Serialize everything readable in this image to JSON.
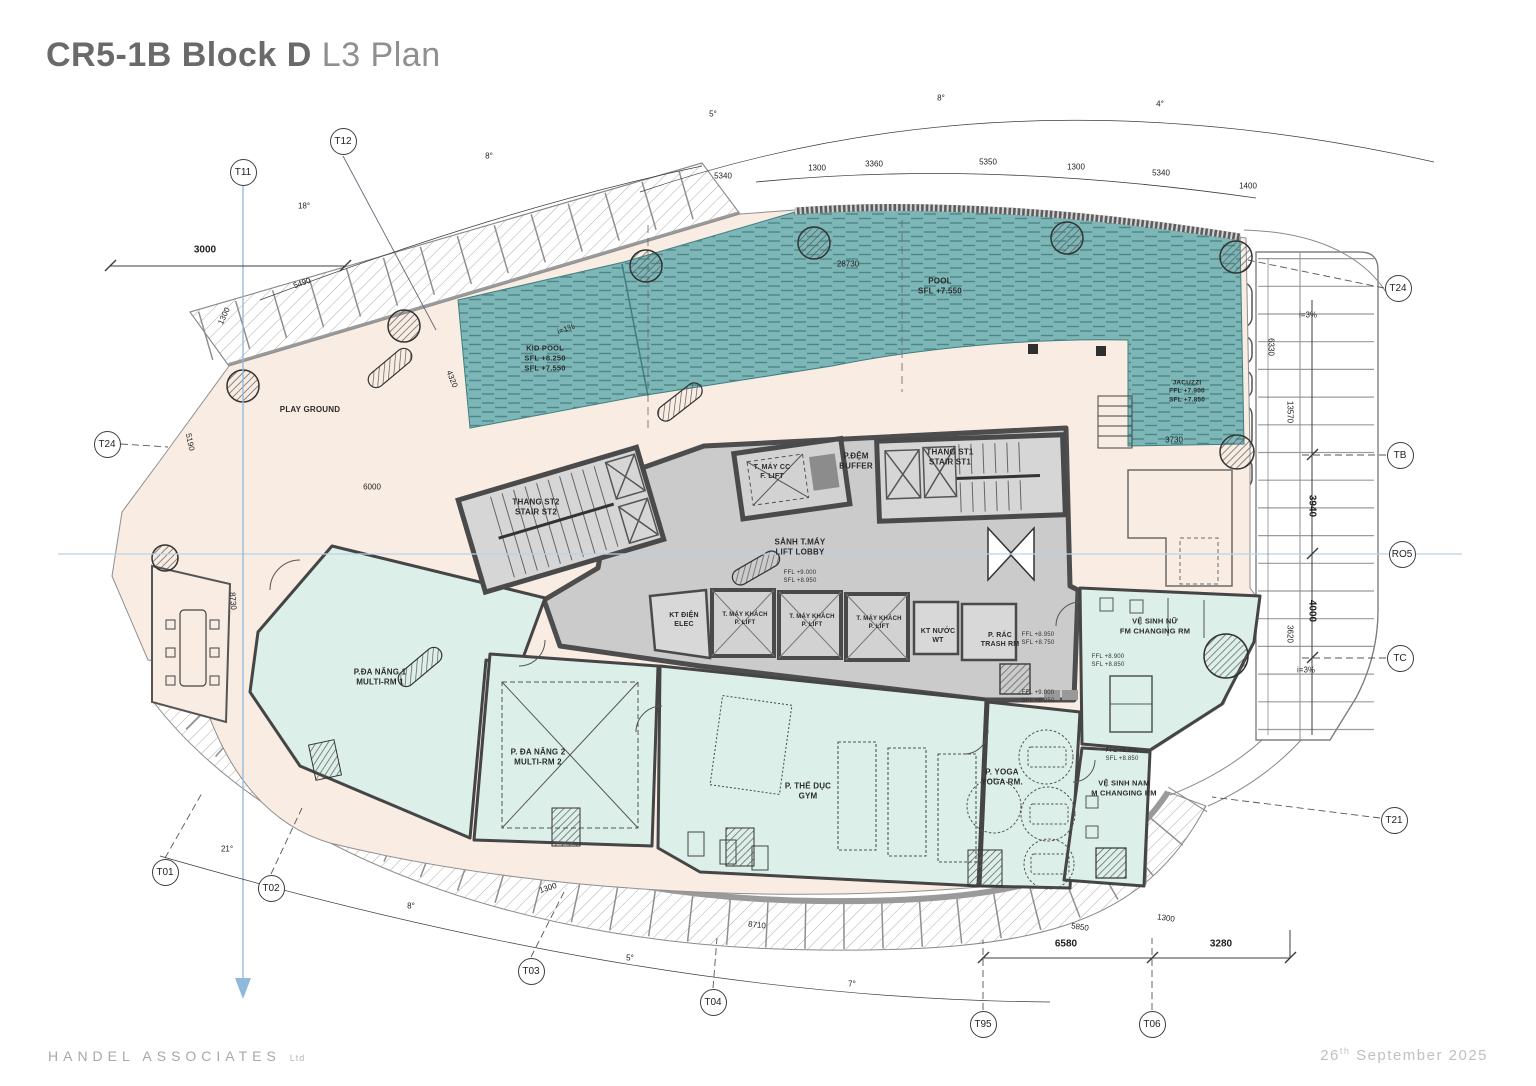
{
  "header": {
    "title_bold": "CR5-1B Block D",
    "title_light": " L3 Plan"
  },
  "footer": {
    "company": "HANDEL ASSOCIATES",
    "suffix": "Ltd",
    "date_day": "26",
    "date_ord": "th",
    "date_rest": " September 2025"
  },
  "colors": {
    "pool": "#7db6b7",
    "pool_dash": "#4d8688",
    "deck": "#f9ece3",
    "room_mint": "#dcefe9",
    "core_gray": "#cbcbcb",
    "grid_blue": "#8fb8da",
    "wall_dark": "#4d4d4d",
    "title_gray": "#6a6a6a"
  },
  "plan": {
    "bubbles": [
      {
        "label": "T12",
        "x": 343,
        "y": 141
      },
      {
        "label": "T11",
        "x": 243,
        "y": 172
      },
      {
        "label": "T24",
        "x": 107,
        "y": 444
      },
      {
        "label": "T24",
        "x": 1398,
        "y": 288
      },
      {
        "label": "TB",
        "x": 1400,
        "y": 455
      },
      {
        "label": "RO5",
        "x": 1402,
        "y": 554
      },
      {
        "label": "TC",
        "x": 1400,
        "y": 658
      },
      {
        "label": "T21",
        "x": 1394,
        "y": 820
      },
      {
        "label": "T01",
        "x": 165,
        "y": 872
      },
      {
        "label": "T02",
        "x": 271,
        "y": 888
      },
      {
        "label": "T03",
        "x": 531,
        "y": 971
      },
      {
        "label": "T04",
        "x": 713,
        "y": 1002
      },
      {
        "label": "T95",
        "x": 983,
        "y": 1024
      },
      {
        "label": "T06",
        "x": 1152,
        "y": 1024
      }
    ],
    "rooms": [
      {
        "id": "pool",
        "text": "POOL\nSFL +7.550",
        "x": 940,
        "y": 287,
        "fs": 8
      },
      {
        "id": "kid-pool",
        "text": "KID POOL\nSFL +8.250\nSFL +7.550",
        "x": 545,
        "y": 358,
        "fs": 7.5
      },
      {
        "id": "jacuzzi",
        "text": "JACUZZI\nFFL +7.900\nSFL +7.850",
        "x": 1187,
        "y": 392,
        "fs": 6.5
      },
      {
        "id": "play-ground",
        "text": "PLAY GROUND",
        "x": 310,
        "y": 410,
        "fs": 8
      },
      {
        "id": "stair-st2",
        "text": "THANG ST2\nSTAIR ST2",
        "x": 536,
        "y": 508,
        "fs": 8
      },
      {
        "id": "fire-lift",
        "text": "T. MÁY CC\nF. LIFT",
        "x": 772,
        "y": 472,
        "fs": 7
      },
      {
        "id": "buffer",
        "text": "P.ĐỆM\nBUFFER",
        "x": 856,
        "y": 462,
        "fs": 8
      },
      {
        "id": "stair-st1",
        "text": "THANG ST1\nSTAIR ST1",
        "x": 950,
        "y": 458,
        "fs": 8
      },
      {
        "id": "lift-lobby",
        "text": "SẢNH T.MÁY\nLIFT LOBBY",
        "x": 800,
        "y": 548,
        "fs": 8
      },
      {
        "id": "lift-lobby-level",
        "text": "FFL +9.000\nSFL +8.950",
        "x": 800,
        "y": 578,
        "fs": 6,
        "lvl": true
      },
      {
        "id": "elec",
        "text": "KT ĐIỆN\nELEC",
        "x": 684,
        "y": 620,
        "fs": 7
      },
      {
        "id": "p-lift-1",
        "text": "T. MÁY KHÁCH\nP. LIFT",
        "x": 745,
        "y": 620,
        "fs": 6
      },
      {
        "id": "p-lift-2",
        "text": "T. MÁY KHÁCH\nP. LIFT",
        "x": 812,
        "y": 622,
        "fs": 6
      },
      {
        "id": "p-lift-3",
        "text": "T. MÁY KHÁCH\nP. LIFT",
        "x": 879,
        "y": 624,
        "fs": 6
      },
      {
        "id": "water-tech",
        "text": "KT NƯỚC\nWT",
        "x": 938,
        "y": 636,
        "fs": 7
      },
      {
        "id": "trash-room",
        "text": "P. RÁC\nTRASH RM",
        "x": 1000,
        "y": 640,
        "fs": 7
      },
      {
        "id": "level-a",
        "text": "FFL +8.950\nSFL +8.750",
        "x": 1038,
        "y": 640,
        "fs": 6,
        "lvl": true
      },
      {
        "id": "level-b",
        "text": "FFL +9.000\nSFL +8.950",
        "x": 1038,
        "y": 698,
        "fs": 6,
        "lvl": true
      },
      {
        "id": "fm-changing",
        "text": "VỆ SINH NỮ\nFM CHANGING RM",
        "x": 1155,
        "y": 626,
        "fs": 7.5
      },
      {
        "id": "fm-level",
        "text": "FFL +8.900\nSFL +8.850",
        "x": 1108,
        "y": 662,
        "fs": 6,
        "lvl": true
      },
      {
        "id": "multi-rm-1",
        "text": "P.ĐA NĂNG 1\nMULTI-RM 1",
        "x": 380,
        "y": 678,
        "fs": 8
      },
      {
        "id": "multi-rm-2",
        "text": "P. ĐA NĂNG 2\nMULTI-RM 2",
        "x": 538,
        "y": 758,
        "fs": 8
      },
      {
        "id": "gym",
        "text": "P. THỂ DỤC\nGYM",
        "x": 808,
        "y": 792,
        "fs": 8
      },
      {
        "id": "yoga",
        "text": "P. YOGA\nYOGA RM.",
        "x": 1002,
        "y": 778,
        "fs": 8
      },
      {
        "id": "m-level",
        "text": "FFL +8.900\nSFL +8.850",
        "x": 1122,
        "y": 756,
        "fs": 6,
        "lvl": true
      },
      {
        "id": "m-changing",
        "text": "VỆ SINH NAM\nM CHANGING RM",
        "x": 1124,
        "y": 788,
        "fs": 7.5
      }
    ],
    "dimensions": [
      {
        "t": "3000",
        "x": 205,
        "y": 250,
        "b": true
      },
      {
        "t": "5340",
        "x": 723,
        "y": 176
      },
      {
        "t": "1300",
        "x": 817,
        "y": 168
      },
      {
        "t": "3360",
        "x": 874,
        "y": 164
      },
      {
        "t": "5350",
        "x": 988,
        "y": 162
      },
      {
        "t": "1300",
        "x": 1076,
        "y": 167
      },
      {
        "t": "5340",
        "x": 1161,
        "y": 173
      },
      {
        "t": "1400",
        "x": 1248,
        "y": 186
      },
      {
        "t": "28730",
        "x": 848,
        "y": 264
      },
      {
        "t": "3730",
        "x": 1174,
        "y": 440
      },
      {
        "t": "6330",
        "x": 1271,
        "y": 347,
        "r": 90
      },
      {
        "t": "13570",
        "x": 1290,
        "y": 412,
        "r": 90
      },
      {
        "t": "3940",
        "x": 1312,
        "y": 506,
        "r": 90,
        "b": true
      },
      {
        "t": "4000",
        "x": 1312,
        "y": 611,
        "r": 90,
        "b": true
      },
      {
        "t": "3620",
        "x": 1290,
        "y": 634,
        "r": 90
      },
      {
        "t": "6580",
        "x": 1066,
        "y": 944,
        "b": true
      },
      {
        "t": "3280",
        "x": 1221,
        "y": 944,
        "b": true
      },
      {
        "t": "8710",
        "x": 757,
        "y": 925,
        "r": 6
      },
      {
        "t": "5850",
        "x": 1080,
        "y": 927,
        "r": 8
      },
      {
        "t": "1300",
        "x": 1166,
        "y": 918,
        "r": 8
      },
      {
        "t": "1300",
        "x": 548,
        "y": 888,
        "r": -18
      },
      {
        "t": "5490",
        "x": 302,
        "y": 283,
        "r": -20
      },
      {
        "t": "1300",
        "x": 224,
        "y": 316,
        "r": -65
      },
      {
        "t": "4320",
        "x": 452,
        "y": 379,
        "r": 68
      },
      {
        "t": "6000",
        "x": 372,
        "y": 487
      },
      {
        "t": "5190",
        "x": 190,
        "y": 442,
        "r": 78
      },
      {
        "t": "8730",
        "x": 233,
        "y": 601,
        "r": 85
      },
      {
        "t": "18°",
        "x": 304,
        "y": 206
      },
      {
        "t": "8°",
        "x": 489,
        "y": 156
      },
      {
        "t": "5°",
        "x": 713,
        "y": 114
      },
      {
        "t": "8°",
        "x": 941,
        "y": 98
      },
      {
        "t": "4°",
        "x": 1160,
        "y": 104
      },
      {
        "t": "21°",
        "x": 227,
        "y": 849
      },
      {
        "t": "8°",
        "x": 411,
        "y": 906
      },
      {
        "t": "5°",
        "x": 630,
        "y": 958
      },
      {
        "t": "7°",
        "x": 852,
        "y": 984
      },
      {
        "t": "i=3%",
        "x": 1308,
        "y": 315
      },
      {
        "t": "i=3%",
        "x": 1306,
        "y": 670
      },
      {
        "t": "i=1%",
        "x": 566,
        "y": 329,
        "r": -20
      }
    ]
  }
}
